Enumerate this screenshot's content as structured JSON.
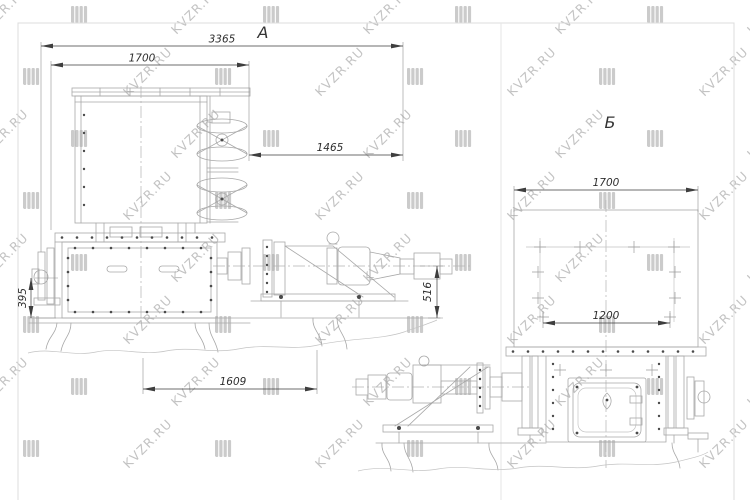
{
  "sheet": {
    "background": "#ffffff",
    "frame_color": "#dcdcdc"
  },
  "watermark": {
    "text": "KVZR.RU",
    "text_color": "#bdbdbd",
    "logo_color": "#c9c9c9"
  },
  "view_a": {
    "label": "А",
    "dimensions": {
      "total_length": "3365",
      "body_length": "1700",
      "drive_offset": "1465",
      "mount_height": "395",
      "base_length": "1609",
      "drive_height": "516"
    }
  },
  "view_b": {
    "label": "Б",
    "dimensions": {
      "body_width": "1700",
      "bolt_span": "1200"
    }
  },
  "palette": {
    "drawing_line": "#a8a8a8",
    "dimension_line": "#3e3e3e",
    "dimension_text": "#2e2e2e",
    "centerline": "#b3b3b3"
  }
}
